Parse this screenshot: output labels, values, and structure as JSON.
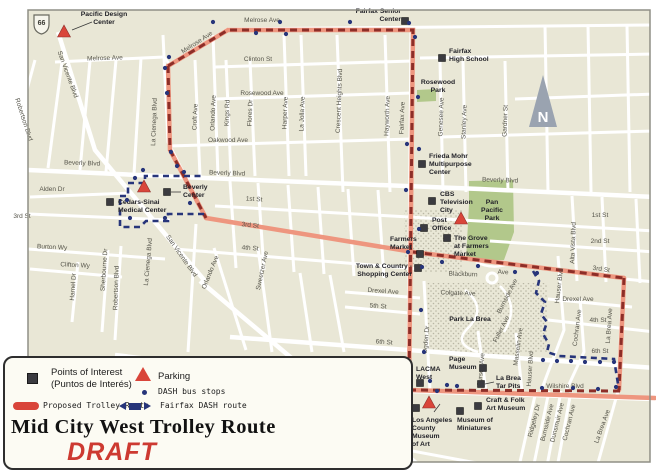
{
  "title": {
    "main": "Mid City West Trolley Route",
    "draft": "DRAFT"
  },
  "legend": {
    "poi_line1": "Points of Interest",
    "poi_line2": "(Puntos de Interés)",
    "parking": "Parking",
    "dash_stops": "DASH bus stops",
    "trolley_route": "Proposed Trolley Route",
    "fairfax_dash": "Fairfax DASH route"
  },
  "colors": {
    "bg": "#e9e7d6",
    "street": "#ffffff",
    "park": "#b2c88b",
    "stipple": "#b9b6a4",
    "pink": "#ee967f",
    "dark_red": "#8d2e28",
    "navy": "#27357a",
    "poi": "#3b3b40",
    "parking": "#d9453a",
    "frame": "#8f8f85",
    "street_text": "#55544a",
    "poi_text": "#232329",
    "north": "#9aa3b0"
  },
  "map": {
    "route66": "66",
    "north": "N",
    "street_labels": [
      {
        "t": "Melrose Ave",
        "x": 105,
        "y": 60,
        "r": -2
      },
      {
        "t": "Melrose Ave",
        "x": 262,
        "y": 22,
        "r": 0
      },
      {
        "t": "Melrose Ave",
        "x": 198,
        "y": 44,
        "r": -33
      },
      {
        "t": "Clinton St",
        "x": 258,
        "y": 61,
        "r": 0
      },
      {
        "t": "Rosewood Ave",
        "x": 262,
        "y": 95,
        "r": 0
      },
      {
        "t": "Oakwood Ave",
        "x": 228,
        "y": 142,
        "r": 0
      },
      {
        "t": "Beverly Blvd",
        "x": 82,
        "y": 165,
        "r": 2
      },
      {
        "t": "Beverly Blvd",
        "x": 227,
        "y": 175,
        "r": 2
      },
      {
        "t": "Beverly Blvd",
        "x": 500,
        "y": 182,
        "r": 2
      },
      {
        "t": "Alden Dr",
        "x": 52,
        "y": 191,
        "r": 0
      },
      {
        "t": "1st St",
        "x": 254,
        "y": 201,
        "r": 3
      },
      {
        "t": "1st St",
        "x": 600,
        "y": 217,
        "r": 0
      },
      {
        "t": "2nd St",
        "x": 600,
        "y": 243,
        "r": 0
      },
      {
        "t": "3rd St",
        "x": 22,
        "y": 218,
        "r": 0
      },
      {
        "t": "3rd St",
        "x": 250,
        "y": 227,
        "r": 6
      },
      {
        "t": "3rd St",
        "x": 601,
        "y": 271,
        "r": 8
      },
      {
        "t": "Burton Wy",
        "x": 52,
        "y": 249,
        "r": 3
      },
      {
        "t": "Clifton Wy",
        "x": 75,
        "y": 267,
        "r": 3
      },
      {
        "t": "4th St",
        "x": 250,
        "y": 250,
        "r": 4
      },
      {
        "t": "4th St",
        "x": 598,
        "y": 322,
        "r": 0
      },
      {
        "t": "5th St",
        "x": 378,
        "y": 308,
        "r": 4
      },
      {
        "t": "6th St",
        "x": 384,
        "y": 344,
        "r": 4
      },
      {
        "t": "6th St",
        "x": 600,
        "y": 353,
        "r": 0
      },
      {
        "t": "Drexel Ave",
        "x": 383,
        "y": 293,
        "r": 4
      },
      {
        "t": "Drexel Ave",
        "x": 578,
        "y": 301,
        "r": 0
      },
      {
        "t": "Wilshire Blvd",
        "x": 345,
        "y": 375,
        "r": 7
      },
      {
        "t": "Wilshire Blvd",
        "x": 565,
        "y": 388,
        "r": 0
      },
      {
        "t": "Olympic Blvd",
        "x": 338,
        "y": 437,
        "r": 9
      },
      {
        "t": "San Vicente Blvd",
        "x": 66,
        "y": 75,
        "r": 70
      },
      {
        "t": "San Vicente Blvd",
        "x": 180,
        "y": 257,
        "r": 55
      },
      {
        "t": "San Vicente Blvd",
        "x": 343,
        "y": 417,
        "r": 28
      },
      {
        "t": "Robertson Blvd",
        "x": 22,
        "y": 120,
        "r": 72
      },
      {
        "t": "Robertson Blvd",
        "x": 118,
        "y": 288,
        "r": -88
      },
      {
        "t": "La Cienega Blvd",
        "x": 156,
        "y": 122,
        "r": -88
      },
      {
        "t": "La Cienega Blvd",
        "x": 150,
        "y": 262,
        "r": -85
      },
      {
        "t": "Croft Ave",
        "x": 197,
        "y": 117,
        "r": -88
      },
      {
        "t": "Orlando Ave",
        "x": 215,
        "y": 113,
        "r": -88
      },
      {
        "t": "Orlando Ave",
        "x": 212,
        "y": 273,
        "r": -68
      },
      {
        "t": "Kings Rd",
        "x": 229,
        "y": 113,
        "r": -88
      },
      {
        "t": "Flores Dr",
        "x": 252,
        "y": 113,
        "r": -88
      },
      {
        "t": "Sweetzer Ave",
        "x": 264,
        "y": 271,
        "r": -78
      },
      {
        "t": "Harper Ave",
        "x": 287,
        "y": 113,
        "r": -88
      },
      {
        "t": "La Jolla Ave",
        "x": 304,
        "y": 114,
        "r": -88
      },
      {
        "t": "Crescent Heights Blvd",
        "x": 341,
        "y": 101,
        "r": -88
      },
      {
        "t": "Hayworth Ave",
        "x": 389,
        "y": 116,
        "r": -88
      },
      {
        "t": "Fairfax Ave",
        "x": 404,
        "y": 118,
        "r": -88
      },
      {
        "t": "Fairfax Ave",
        "x": 396,
        "y": 421,
        "r": -73
      },
      {
        "t": "Genesee Ave",
        "x": 443,
        "y": 117,
        "r": -88
      },
      {
        "t": "Stanley Ave",
        "x": 466,
        "y": 122,
        "r": -88
      },
      {
        "t": "Gardner St",
        "x": 507,
        "y": 121,
        "r": -88
      },
      {
        "t": "Alta Vista Blvd",
        "x": 575,
        "y": 243,
        "r": -88
      },
      {
        "t": "Sherbourne Dr",
        "x": 106,
        "y": 270,
        "r": -86
      },
      {
        "t": "Hamel Dr",
        "x": 75,
        "y": 287,
        "r": -86
      },
      {
        "t": "Ogden Dr",
        "x": 428,
        "y": 340,
        "r": -85
      },
      {
        "t": "Curson Ave",
        "x": 483,
        "y": 370,
        "r": -85
      },
      {
        "t": "Masselin Ave",
        "x": 520,
        "y": 347,
        "r": -82
      },
      {
        "t": "Hauser Blvd",
        "x": 561,
        "y": 286,
        "r": -83
      },
      {
        "t": "Hauser Blvd",
        "x": 532,
        "y": 369,
        "r": -86
      },
      {
        "t": "Cochran Ave",
        "x": 579,
        "y": 328,
        "r": -83
      },
      {
        "t": "Cochran Ave",
        "x": 571,
        "y": 423,
        "r": -76
      },
      {
        "t": "La Brea Ave",
        "x": 611,
        "y": 326,
        "r": -86
      },
      {
        "t": "La Brea Ave",
        "x": 604,
        "y": 427,
        "r": -70
      },
      {
        "t": "Burnside Ave",
        "x": 509,
        "y": 297,
        "r": -63
      },
      {
        "t": "Burnside Ave",
        "x": 549,
        "y": 423,
        "r": -76
      },
      {
        "t": "Fuller Ave",
        "x": 503,
        "y": 330,
        "r": -63
      },
      {
        "t": "Ridgeley Dr",
        "x": 536,
        "y": 421,
        "r": -76
      },
      {
        "t": "Dunsmuir Ave",
        "x": 559,
        "y": 423,
        "r": -76
      },
      {
        "t": "Blackburn",
        "x": 463,
        "y": 276,
        "r": 2
      },
      {
        "t": "Ave",
        "x": 503,
        "y": 274,
        "r": 2
      },
      {
        "t": "Colgate Ave",
        "x": 458,
        "y": 295,
        "r": 2
      }
    ],
    "place_labels": [
      {
        "lines": [
          "Rosewood",
          "Park"
        ],
        "x": 438,
        "y": 84,
        "anchor": "middle"
      },
      {
        "lines": [
          "Pan",
          "Pacific",
          "Park"
        ],
        "x": 492,
        "y": 204,
        "anchor": "middle"
      },
      {
        "lines": [
          "Park La Brea"
        ],
        "x": 470,
        "y": 321,
        "anchor": "middle"
      }
    ],
    "poi_squares": [
      {
        "id": "fairfax-senior-center",
        "sx": 405,
        "sy": 21,
        "lines": [
          "Fairfax Senior",
          "Center"
        ],
        "lx": 401,
        "ly": 13,
        "anchor": "end"
      },
      {
        "id": "fairfax-high-school",
        "sx": 442,
        "sy": 58,
        "lines": [
          "Fairfax",
          "High School"
        ],
        "lx": 449,
        "ly": 53,
        "anchor": "start"
      },
      {
        "id": "beverly-center",
        "sx": 167,
        "sy": 192,
        "lines": [
          "Beverly",
          "Center"
        ],
        "lx": 183,
        "ly": 189,
        "anchor": "start"
      },
      {
        "id": "cedars-sinai-medical-center",
        "sx": 110,
        "sy": 202,
        "lines": [
          "Cedars-Sinai",
          "Medical Center"
        ],
        "lx": 118,
        "ly": 204,
        "anchor": "start"
      },
      {
        "id": "frieda-mohr-multipurpose-center",
        "sx": 422,
        "sy": 164,
        "lines": [
          "Frieda Mohr",
          "Multipurpose",
          "Center"
        ],
        "lx": 429,
        "ly": 158,
        "anchor": "start"
      },
      {
        "id": "cbs-television-city",
        "sx": 432,
        "sy": 201,
        "lines": [
          "CBS",
          "Television",
          "City"
        ],
        "lx": 440,
        "ly": 196,
        "anchor": "start"
      },
      {
        "id": "post-office",
        "sx": 424,
        "sy": 228,
        "lines": [
          "Post",
          "Office"
        ],
        "lx": 432,
        "ly": 222,
        "anchor": "start"
      },
      {
        "id": "the-grove-at-farmers-market",
        "sx": 447,
        "sy": 238,
        "lines": [
          "The Grove",
          "at Farmers",
          "Market"
        ],
        "lx": 454,
        "ly": 240,
        "anchor": "start"
      },
      {
        "id": "farmers-market",
        "sx": 420,
        "sy": 254,
        "lines": [
          "Farmers",
          "Market"
        ],
        "lx": 390,
        "ly": 241,
        "anchor": "start"
      },
      {
        "id": "town-country-shopping-center",
        "sx": 418,
        "sy": 268,
        "lines": [
          "Town & Country -",
          "Shopping Center"
        ],
        "lx": 412,
        "ly": 268,
        "anchor": "end"
      },
      {
        "id": "page-museum",
        "sx": 483,
        "sy": 368,
        "lines": [
          "Page",
          "Museum"
        ],
        "lx": 449,
        "ly": 361,
        "anchor": "start"
      },
      {
        "id": "lacma-west",
        "sx": 420,
        "sy": 383,
        "lines": [
          "LACMA",
          "West"
        ],
        "lx": 416,
        "ly": 371,
        "anchor": "start"
      },
      {
        "id": "la-brea-tar-pits",
        "sx": 481,
        "sy": 384,
        "lines": [
          "La Brea",
          "Tar Pits"
        ],
        "lx": 496,
        "ly": 380,
        "anchor": "start"
      },
      {
        "id": "petersen-automotive-museum",
        "sx": 416,
        "sy": 408,
        "lines": [
          "Petersen",
          "Automotive",
          "Museum"
        ],
        "lx": 404,
        "ly": 407,
        "anchor": "end"
      },
      {
        "id": "craft-folk-art-museum",
        "sx": 478,
        "sy": 406,
        "lines": [
          "Craft & Folk",
          "Art Museum"
        ],
        "lx": 486,
        "ly": 402,
        "anchor": "start"
      },
      {
        "id": "museum-of-miniatures",
        "sx": 460,
        "sy": 411,
        "lines": [
          "Museum of",
          "Miniatures"
        ],
        "lx": 457,
        "ly": 422,
        "anchor": "start"
      }
    ],
    "parking_triangles": [
      {
        "id": "pacific-design-center",
        "tx": 64,
        "ty": 32,
        "lines": [
          "Pacific Design",
          "Center"
        ],
        "lx": 104,
        "ly": 16,
        "anchor": "middle"
      },
      {
        "id": "beverly-center-parking",
        "tx": 144,
        "ty": 187,
        "lines": [],
        "lx": 0,
        "ly": 0,
        "anchor": "start"
      },
      {
        "id": "farmers-market-parking",
        "tx": 461,
        "ty": 219,
        "lines": [],
        "lx": 0,
        "ly": 0,
        "anchor": "start"
      },
      {
        "id": "lacma-parking",
        "tx": 429,
        "ty": 403,
        "lines": [
          "Los Angeles",
          "County",
          "Museum",
          "of Art"
        ],
        "lx": 412,
        "ly": 422,
        "anchor": "start"
      }
    ],
    "connectors": [
      [
        171,
        192,
        181,
        192
      ],
      [
        72,
        30,
        92,
        22
      ],
      [
        485,
        384,
        494,
        382
      ],
      [
        406,
        409,
        413,
        408
      ],
      [
        434,
        412,
        440,
        404
      ]
    ],
    "dash_stops": [
      [
        213,
        22
      ],
      [
        280,
        22
      ],
      [
        350,
        22
      ],
      [
        409,
        23
      ],
      [
        256,
        33
      ],
      [
        286,
        34
      ],
      [
        415,
        37
      ],
      [
        169,
        57
      ],
      [
        165,
        68
      ],
      [
        167,
        93
      ],
      [
        171,
        152
      ],
      [
        135,
        178
      ],
      [
        143,
        170
      ],
      [
        177,
        166
      ],
      [
        184,
        172
      ],
      [
        127,
        200
      ],
      [
        190,
        203
      ],
      [
        165,
        218
      ],
      [
        130,
        218
      ],
      [
        418,
        97
      ],
      [
        407,
        144
      ],
      [
        419,
        149
      ],
      [
        406,
        190
      ],
      [
        419,
        229
      ],
      [
        408,
        252
      ],
      [
        422,
        267
      ],
      [
        421,
        310
      ],
      [
        424,
        352
      ],
      [
        442,
        262
      ],
      [
        478,
        266
      ],
      [
        515,
        272
      ],
      [
        537,
        273
      ],
      [
        543,
        360
      ],
      [
        557,
        361
      ],
      [
        571,
        361
      ],
      [
        585,
        362
      ],
      [
        600,
        362
      ],
      [
        614,
        362
      ],
      [
        447,
        385
      ],
      [
        457,
        386
      ],
      [
        542,
        388
      ],
      [
        573,
        388
      ],
      [
        598,
        389
      ],
      [
        616,
        387
      ],
      [
        430,
        381
      ],
      [
        437,
        391
      ]
    ],
    "streets": [
      "55,62 164,57",
      "164,57 170,65",
      "168,65 228,29",
      "228,29 655,25",
      "215,67 412,61",
      "420,58 655,54",
      "215,99 412,93",
      "515,99 655,94",
      "168,146 412,139",
      "440,137 655,131",
      "30,197 130,193",
      "215,206 655,231",
      "490,241 655,252",
      "5,213 170,220",
      "624,279 655,282",
      "28,249 165,259",
      "30,269 122,277",
      "175,249 420,269",
      "548,320 655,332",
      "345,292 420,298",
      "548,299 632,307",
      "345,307 420,314",
      "225,416 530,473",
      "35,60 8,160",
      "121,246 115,340",
      "78,262 72,322",
      "108,250 102,332",
      "196,224 188,352",
      "163,35 168,142 206,218",
      "195,60 200,176",
      "213,35 218,176",
      "214,248 246,350",
      "226,60 231,176",
      "250,60 255,176",
      "258,248 272,352",
      "284,35 289,176",
      "301,35 306,176",
      "337,35 343,192",
      "385,35 390,192",
      "411,28 408,391",
      "408,391 380,470",
      "440,61 443,192",
      "463,61 466,192",
      "505,61 508,192",
      "545,25 548,192",
      "588,25 591,192",
      "627,25 630,192",
      "572,196 577,281",
      "602,197 606,282",
      "636,199 640,283",
      "424,281 430,391",
      "478,331 486,391",
      "516,333 522,391",
      "558,256 564,330 541,391",
      "580,298 584,352 566,391",
      "623,279 618,391 596,470",
      "536,391 520,462",
      "549,391 534,464",
      "561,391 547,466",
      "571,391 557,468",
      "62,62 48,168",
      "90,61 80,170",
      "116,60 106,172",
      "141,58 134,174",
      "230,181 236,268",
      "258,183 264,270",
      "288,185 294,272",
      "318,187 324,274",
      "348,189 354,276",
      "378,190 384,278",
      "300,273 312,352",
      "330,275 344,352"
    ],
    "streets_wide": [
      "28,170 205,178 480,189 655,197",
      "230,337 655,368",
      "115,355 412,391 655,399",
      "200,281 428,473",
      "58,32 95,150 170,240 205,281"
    ],
    "curves": [
      "M465,290 Q488,308 468,328 Q452,344 478,352",
      "M500,286 Q520,306 504,332",
      "M476,262 Q492,270 508,264"
    ],
    "routes": {
      "pink": [
        "168,66 228,30 413,30 409,390",
        "168,66 170,150 206,218",
        "206,218 413,252 624,278",
        "624,278 619,390",
        "409,390 655,398"
      ],
      "dark_dash": [
        "168,66 228,30 413,30 409,390",
        "168,66 170,150 206,218",
        "413,252 624,278",
        "624,278 619,390",
        "409,390 620,391"
      ],
      "blue": [
        "120,196 128,196 128,183 145,183 145,176 204,176",
        "204,214 168,214 168,221 146,221 140,227 120,227 120,197",
        "533,271 539,281 536,293 545,302 541,314 547,322 543,334 549,344 547,352 559,356 614,359 618,384"
      ]
    },
    "parks": [
      "417,90 436,89 436,101 417,102",
      "469,181 513,180 514,232 504,260 466,260 469,205"
    ],
    "stipple": [
      {
        "x": 404,
        "y": 210,
        "w": 58,
        "h": 62
      },
      {
        "x": 427,
        "y": 283,
        "w": 120,
        "h": 69
      },
      {
        "x": 466,
        "y": 338,
        "w": 54,
        "h": 18
      }
    ]
  }
}
